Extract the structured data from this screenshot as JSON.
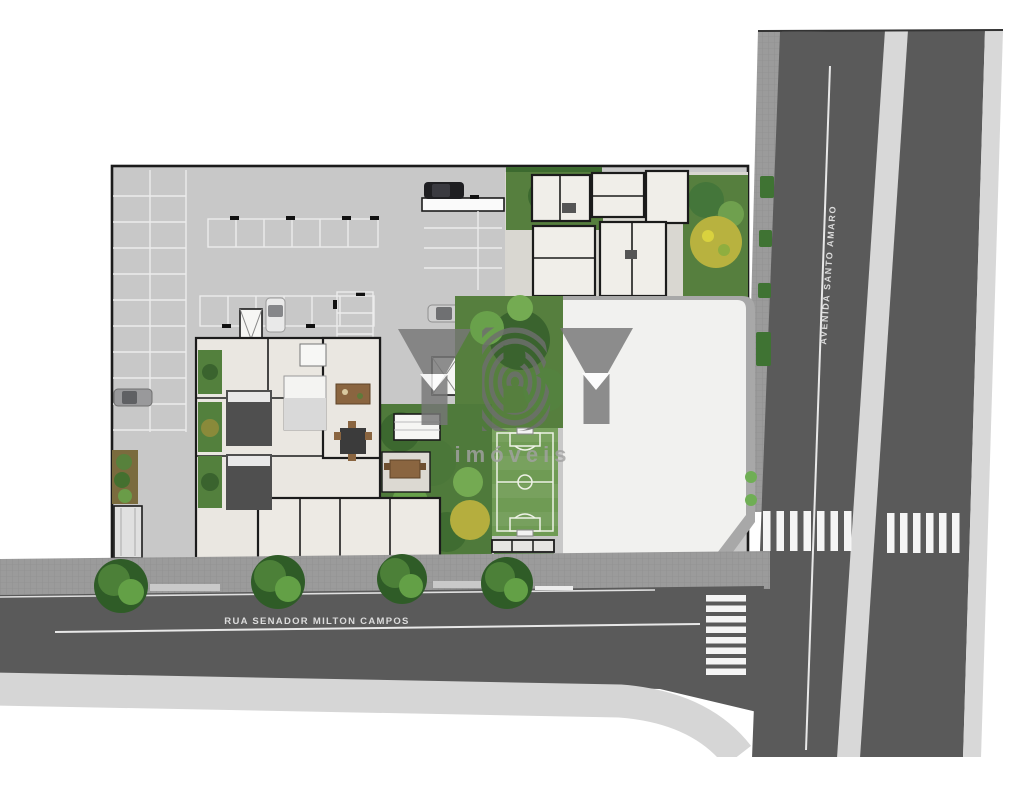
{
  "page": {
    "background": "#ffffff",
    "description_hint": "site plan"
  },
  "streets": {
    "bottom_label": "RUA SENADOR MILTON CAMPOS",
    "right_label": "AVENIDA SANTO AMARO"
  },
  "watermark": {
    "left": "Y",
    "middle": "B",
    "right": "Y",
    "subtitle": "imóveis"
  },
  "colors": {
    "road": "#5a5a5a",
    "road_line": "#e8e8e8",
    "median": "#d8d8d8",
    "sidewalk": "#9b9b9b",
    "sidewalk_light": "#d6d6d6",
    "concrete": "#c8c8c8",
    "floor": "#eae7e1",
    "paving": "#d9d7d1",
    "garden": "#567f3e",
    "tree_dark": "#3c682f",
    "tree_light": "#6fa84e",
    "yellow_tree": "#b8b23f",
    "field": "#6f9b54",
    "field_line": "#eef2e6",
    "footprint": "#f1f1ef",
    "footprint_border": "#a8a8a8",
    "watermark": "#777777",
    "watermark_text": "#a2a2a2",
    "street_text": "#dcdcdc",
    "crosswalk": "#f5f5f5"
  }
}
